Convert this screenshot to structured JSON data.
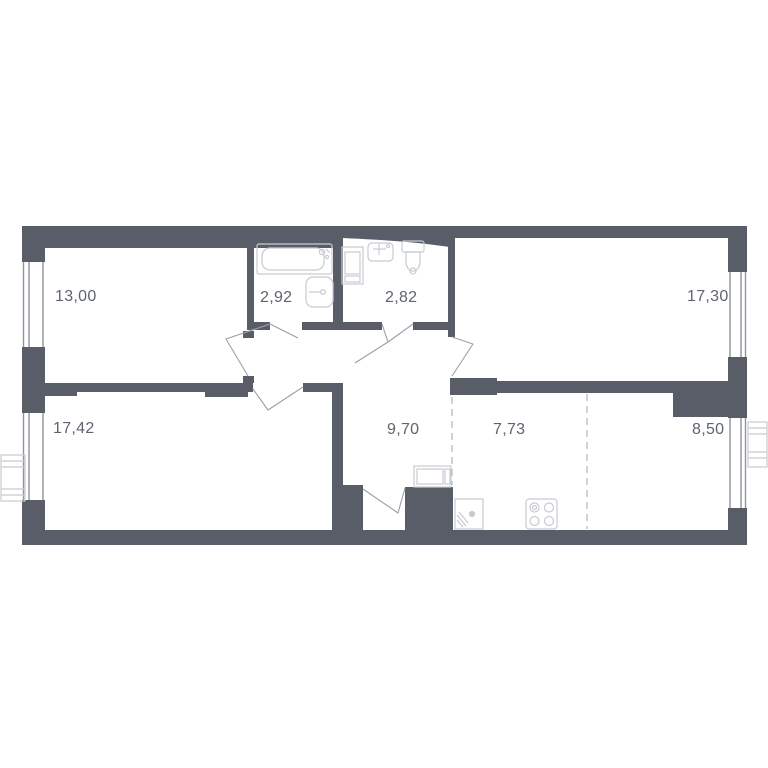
{
  "plan": {
    "title": "apartment-floor-plan",
    "rooms": [
      {
        "id": "living-room",
        "area": "13,00"
      },
      {
        "id": "bathroom",
        "area": "2,92"
      },
      {
        "id": "wc",
        "area": "2,82"
      },
      {
        "id": "bedroom-right",
        "area": "17,30"
      },
      {
        "id": "bedroom-left",
        "area": "17,42"
      },
      {
        "id": "hallway",
        "area": "9,70"
      },
      {
        "id": "kitchen",
        "area": "7,73"
      },
      {
        "id": "dining-zone",
        "area": "8,50"
      }
    ],
    "fixtures": [
      "bathtub-icon",
      "bath-sink-icon",
      "washing-machine-icon",
      "wc-sink-icon",
      "toilet-icon",
      "wardrobe-icon",
      "kitchen-sink-icon",
      "stove-icon",
      "ac-unit-left-icon",
      "ac-unit-right-icon"
    ],
    "colors": {
      "wall": "#585d68",
      "fixture_line": "#c7cbd1",
      "door_line": "#9aa0a8",
      "dashed_line": "#b5b9c0",
      "window_line": "#8f949d",
      "label_text": "#5f6470",
      "background": "#ffffff"
    }
  }
}
